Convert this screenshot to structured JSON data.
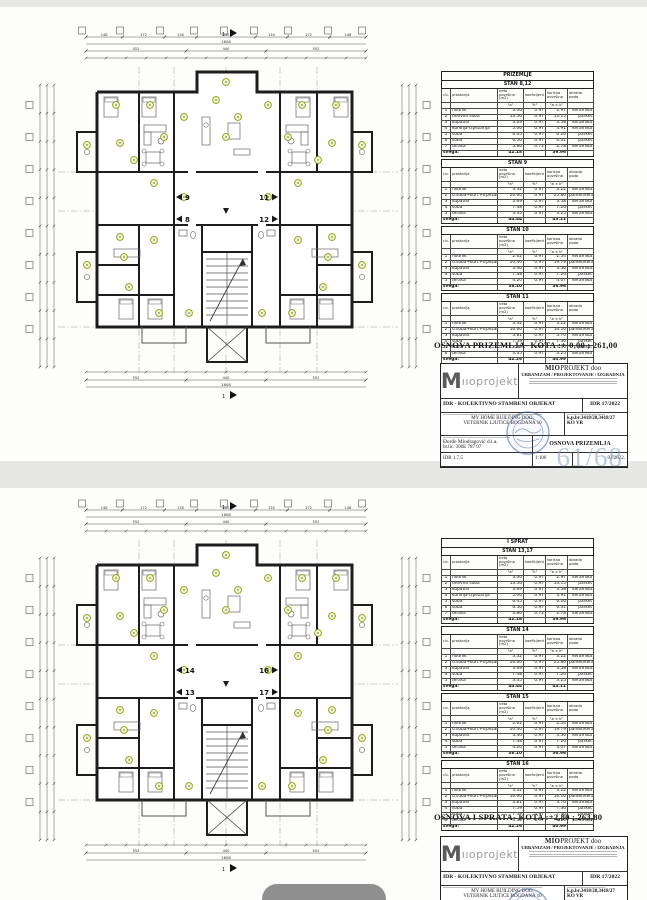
{
  "ui": {
    "background": "#e7e7e5",
    "bottom_pill_color": "#8f8f8f"
  },
  "table_headers": {
    "col_no": "r.b.",
    "col_room": "prostorija",
    "col_net": "neto površina (m2)",
    "col_net_sub": "\"a\"",
    "col_coef": "koeficijent",
    "col_coef_sub": "\"k\"",
    "col_useful": "korisna površina",
    "col_useful_sub": "\"a × k\"",
    "col_floor": "obrada poda",
    "total_label": "svega:"
  },
  "dims": {
    "total": "1608",
    "thirds": [
      "552",
      "440",
      "552"
    ],
    "segs": [
      "148",
      "172",
      "130",
      "240",
      "130",
      "172",
      "148"
    ],
    "section_label": "1"
  },
  "plan_colors": {
    "wall": "#1d1d1d",
    "marker_stroke": "#7ca300",
    "marker_fill": "#f3f6d6"
  },
  "titleblock_common": {
    "logo_m": "M",
    "logo_rest": "ııoprojekt",
    "company_bold": "MIO",
    "company_rest": "PROJEKT doo",
    "company_sub": "URBANIZAM / PROJEKTOVANJE / IZGRADNJA",
    "project": "IDR - KOLEKTIVNO STAMBENI OBJEKAT",
    "project_no": "IDR 17/2022",
    "investor_line1": "MY HOME BUILDING DOO,",
    "investor_line2": "VETERNIK LJUTICE BOGDANA 10",
    "parcel_line1": "k.p.br.3418/28,3418/27",
    "parcel_line2": "KO VR",
    "designer": "Đorđe Miodragović d.i.a.",
    "license": "br.lic.    300E 787 07",
    "doc_no": "IDR 1.7.5",
    "scale": "1:100",
    "date": "03.2022."
  },
  "sheets": [
    {
      "floor_header": "PRIZEMLJE",
      "caption": "OSNOVA PRIZEMLJA-  KOTA :+-0,00 ; 261,00",
      "drawing_title": "OSNOVA PRIZEMLJA",
      "watermark": "61/68",
      "apartments": [
        "9",
        "11",
        "8",
        "12"
      ],
      "tables": [
        {
          "title": "STAN 8,12",
          "rows": [
            [
              "1",
              "hodnik",
              "3.06",
              "0.97",
              "2.97",
              "keramika"
            ],
            [
              "2",
              "dnevna soba",
              "13.56",
              "0.97",
              "13.15",
              "parket"
            ],
            [
              "3",
              "kupatilo",
              "3.69",
              "0.97",
              "3.58",
              "keramika"
            ],
            [
              "4",
              "kuhinja-trpezarija",
              "5.06",
              "0.97",
              "4.91",
              "keramika"
            ],
            [
              "5",
              "soba",
              "6.45",
              "0.97",
              "6.26",
              "parket"
            ],
            [
              "6",
              "soba",
              "6.50",
              "0.97",
              "6.31",
              "parket"
            ],
            [
              "7",
              "terasa",
              "3.86",
              "0.72",
              "2.78",
              "keramika"
            ]
          ],
          "total_net": "42.18",
          "total_useful": "39.96"
        },
        {
          "title": "STAN 9",
          "rows": [
            [
              "1",
              "hodnik",
              "3.32",
              "0.97",
              "3.22",
              "keramika"
            ],
            [
              "2",
              "d.soba+kuh.+trpezarija",
              "26.60",
              "0.97",
              "25.80",
              "parket/keramika"
            ],
            [
              "3",
              "kupatilo",
              "3.69",
              "0.97",
              "3.58",
              "keramika"
            ],
            [
              "4",
              "soba",
              "7.48",
              "0.97",
              "7.26",
              "parket"
            ],
            [
              "5",
              "terasa",
              "3.35",
              "0.97",
              "3.25",
              "keramika"
            ]
          ],
          "total_net": "44.44",
          "total_useful": "43.11"
        },
        {
          "title": "STAN 10",
          "rows": [
            [
              "1",
              "hodnik",
              "2.62",
              "0.97",
              "2.54",
              "keramika"
            ],
            [
              "2",
              "d.soba+kuh.+trpezarija",
              "20.40",
              "0.97",
              "19.79",
              "parket/keramika"
            ],
            [
              "3",
              "kupatilo",
              "3.40",
              "0.97",
              "3.30",
              "keramika"
            ],
            [
              "4",
              "soba",
              "7.48",
              "0.97",
              "7.26",
              "parket"
            ],
            [
              "5",
              "terasa",
              "4.20",
              "0.97",
              "4.07",
              "keramika"
            ]
          ],
          "total_net": "38.10",
          "total_useful": "36.96"
        },
        {
          "title": "STAN 11",
          "rows": [
            [
              "1",
              "hodnik",
              "3.32",
              "0.97",
              "3.22",
              "keramika"
            ],
            [
              "2",
              "d.soba+kuh.+trpezarija",
              "16.60",
              "0.97",
              "16.10",
              "parket/keramika"
            ],
            [
              "3",
              "kupatilo",
              "3.81",
              "0.97",
              "3.70",
              "keramika"
            ],
            [
              "4",
              "soba",
              "7.59",
              "0.97",
              "7.36",
              "parket"
            ],
            [
              "5",
              "soba",
              "7.59",
              "0.97",
              "7.36",
              "parket"
            ],
            [
              "6",
              "terasa",
              "3.35",
              "0.97",
              "3.25",
              "keramika"
            ]
          ],
          "total_net": "42.26",
          "total_useful": "40.99"
        }
      ]
    },
    {
      "floor_header": "I SPRAT",
      "caption": "OSNOVA I SPRATA-  KOTA :+2,80 ; 263,80",
      "drawing_title": "",
      "watermark": "",
      "apartments": [
        "14",
        "16",
        "13",
        "17"
      ],
      "tables": [
        {
          "title": "STAN 13,17",
          "rows": [
            [
              "1",
              "hodnik",
              "3.06",
              "0.97",
              "2.97",
              "keramika"
            ],
            [
              "2",
              "dnevna soba",
              "13.56",
              "0.97",
              "13.15",
              "parket"
            ],
            [
              "3",
              "kupatilo",
              "3.69",
              "0.97",
              "3.58",
              "keramika"
            ],
            [
              "4",
              "kuhinja-trpezarija",
              "5.06",
              "0.97",
              "4.91",
              "keramika"
            ],
            [
              "5",
              "soba",
              "6.45",
              "0.97",
              "6.26",
              "parket"
            ],
            [
              "6",
              "soba",
              "6.50",
              "0.97",
              "6.31",
              "parket"
            ],
            [
              "7",
              "terasa",
              "3.86",
              "0.72",
              "2.78",
              "keramika"
            ]
          ],
          "total_net": "42.18",
          "total_useful": "39.96"
        },
        {
          "title": "STAN 14",
          "rows": [
            [
              "1",
              "hodnik",
              "3.32",
              "0.97",
              "3.22",
              "keramika"
            ],
            [
              "2",
              "d.soba+kuh.+trpezarija",
              "26.60",
              "0.97",
              "25.80",
              "parket/keramika"
            ],
            [
              "3",
              "kupatilo",
              "3.69",
              "0.97",
              "3.58",
              "keramika"
            ],
            [
              "4",
              "soba",
              "7.48",
              "0.97",
              "7.26",
              "parket"
            ],
            [
              "5",
              "terasa",
              "3.35",
              "0.97",
              "3.25",
              "keramika"
            ]
          ],
          "total_net": "44.44",
          "total_useful": "43.11"
        },
        {
          "title": "STAN 15",
          "rows": [
            [
              "1",
              "hodnik",
              "2.62",
              "0.97",
              "2.54",
              "keramika"
            ],
            [
              "2",
              "d.soba+kuh.+trpezarija",
              "20.40",
              "0.97",
              "19.79",
              "parket/keramika"
            ],
            [
              "3",
              "kupatilo",
              "3.40",
              "0.97",
              "3.30",
              "keramika"
            ],
            [
              "4",
              "soba",
              "7.48",
              "0.97",
              "7.26",
              "parket"
            ],
            [
              "5",
              "terasa",
              "4.20",
              "0.97",
              "4.07",
              "keramika"
            ]
          ],
          "total_net": "38.10",
          "total_useful": "36.96"
        },
        {
          "title": "STAN 16",
          "rows": [
            [
              "1",
              "hodnik",
              "3.32",
              "0.97",
              "3.22",
              "keramika"
            ],
            [
              "2",
              "d.soba+kuh.+trpezarija",
              "16.60",
              "0.97",
              "16.10",
              "parket/keramika"
            ],
            [
              "3",
              "kupatilo",
              "3.81",
              "0.97",
              "3.70",
              "keramika"
            ],
            [
              "4",
              "soba",
              "7.59",
              "0.97",
              "7.36",
              "parket"
            ],
            [
              "5",
              "soba",
              "7.59",
              "0.97",
              "7.36",
              "parket"
            ],
            [
              "6",
              "terasa",
              "3.35",
              "0.97",
              "3.25",
              "keramika"
            ]
          ],
          "total_net": "42.26",
          "total_useful": "40.99"
        }
      ]
    }
  ]
}
